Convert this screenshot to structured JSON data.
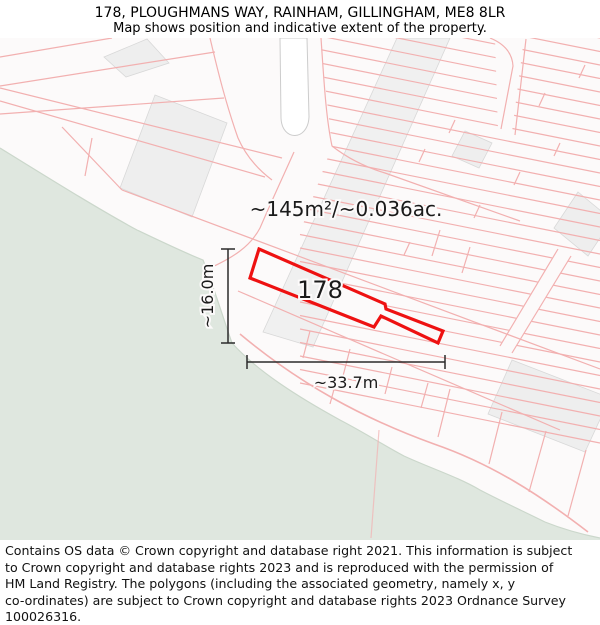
{
  "header": {
    "title": "178, PLOUGHMANS WAY, RAINHAM, GILLINGHAM, ME8 8LR",
    "subtitle": "Map shows position and indicative extent of the property."
  },
  "map": {
    "area_label": "~145m²/~0.036ac.",
    "plot_number": "178",
    "width_label": "~33.7m",
    "height_label": "~16.0m"
  },
  "footer": {
    "lines": [
      "Contains OS data © Crown copyright and database right 2021. This information is subject",
      "to Crown copyright and database rights 2023 and is reproduced with the permission of",
      "HM Land Registry. The polygons (including the associated geometry, namely x, y",
      "co-ordinates) are subject to Crown copyright and database rights 2023 Ordnance Survey",
      "100026316."
    ]
  },
  "colors": {
    "property_outline": "#ee1111",
    "parcel_line": "#f2b0b0",
    "field_green": "#dfe7df",
    "field_border": "#cbd7cb",
    "building_fill": "#eeeeee",
    "building_border": "#d8d8d8",
    "map_background": "#fcfafa"
  }
}
